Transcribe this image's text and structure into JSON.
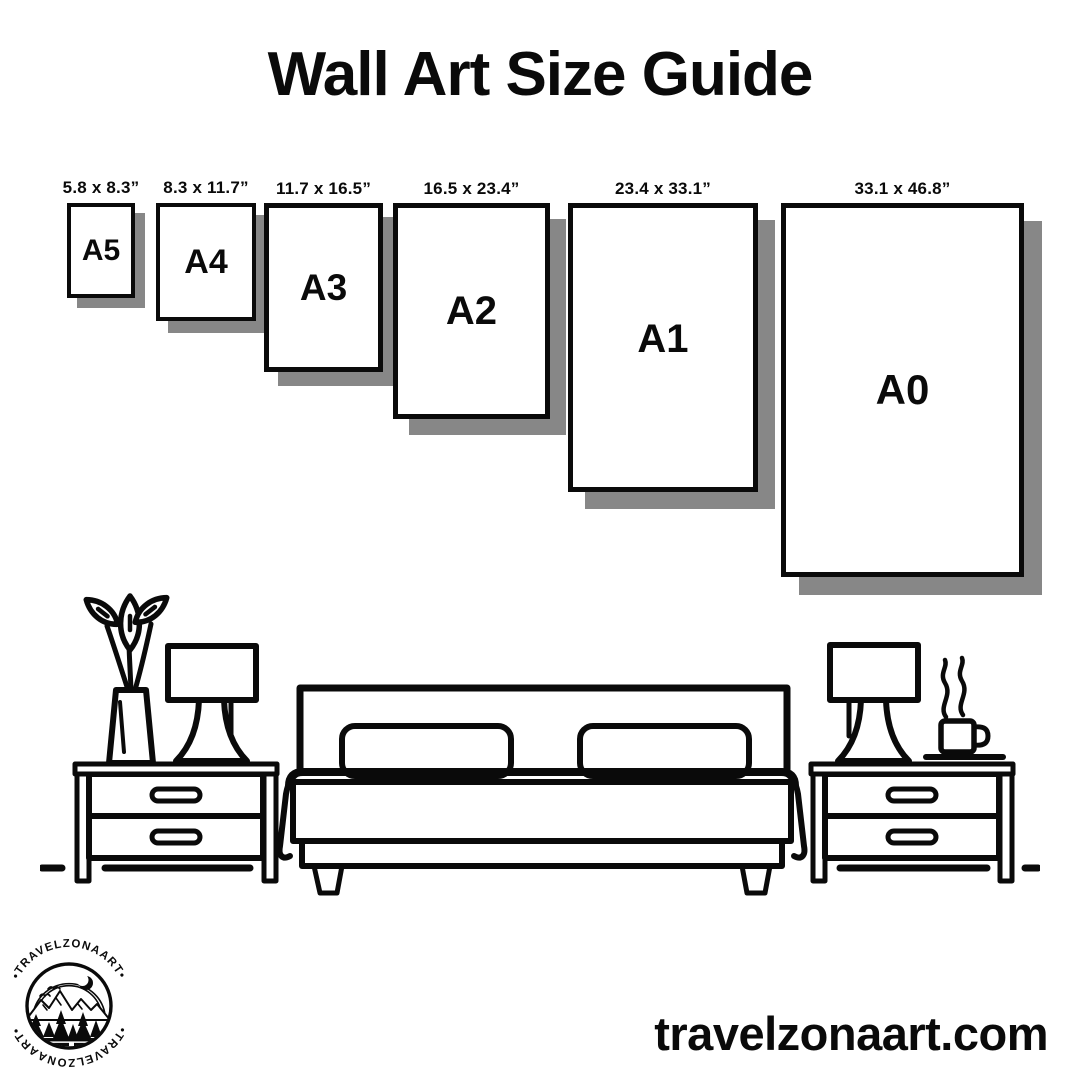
{
  "title": "Wall Art Size Guide",
  "sizes": [
    {
      "label": "A5",
      "dimensions": "5.8 x 8.3”"
    },
    {
      "label": "A4",
      "dimensions": "8.3 x 11.7”"
    },
    {
      "label": "A3",
      "dimensions": "11.7 x 16.5”"
    },
    {
      "label": "A2",
      "dimensions": "16.5 x 23.4”"
    },
    {
      "label": "A1",
      "dimensions": "23.4 x 33.1”"
    },
    {
      "label": "A0",
      "dimensions": "33.1 x 46.8”"
    }
  ],
  "colors": {
    "ink": "#0a0a0a",
    "background": "#ffffff",
    "frame_shadow": "#878787"
  },
  "logo": {
    "brand": "TRAVELZONAART",
    "arc_text": "•TRAVELZONAART•"
  },
  "website": "travelzonaart.com",
  "illustration": {
    "icons": [
      "plant-vase-icon",
      "table-lamp-icon",
      "nightstand-icon",
      "double-bed-icon",
      "table-lamp-icon",
      "steaming-coffee-cup-icon",
      "nightstand-icon"
    ]
  }
}
